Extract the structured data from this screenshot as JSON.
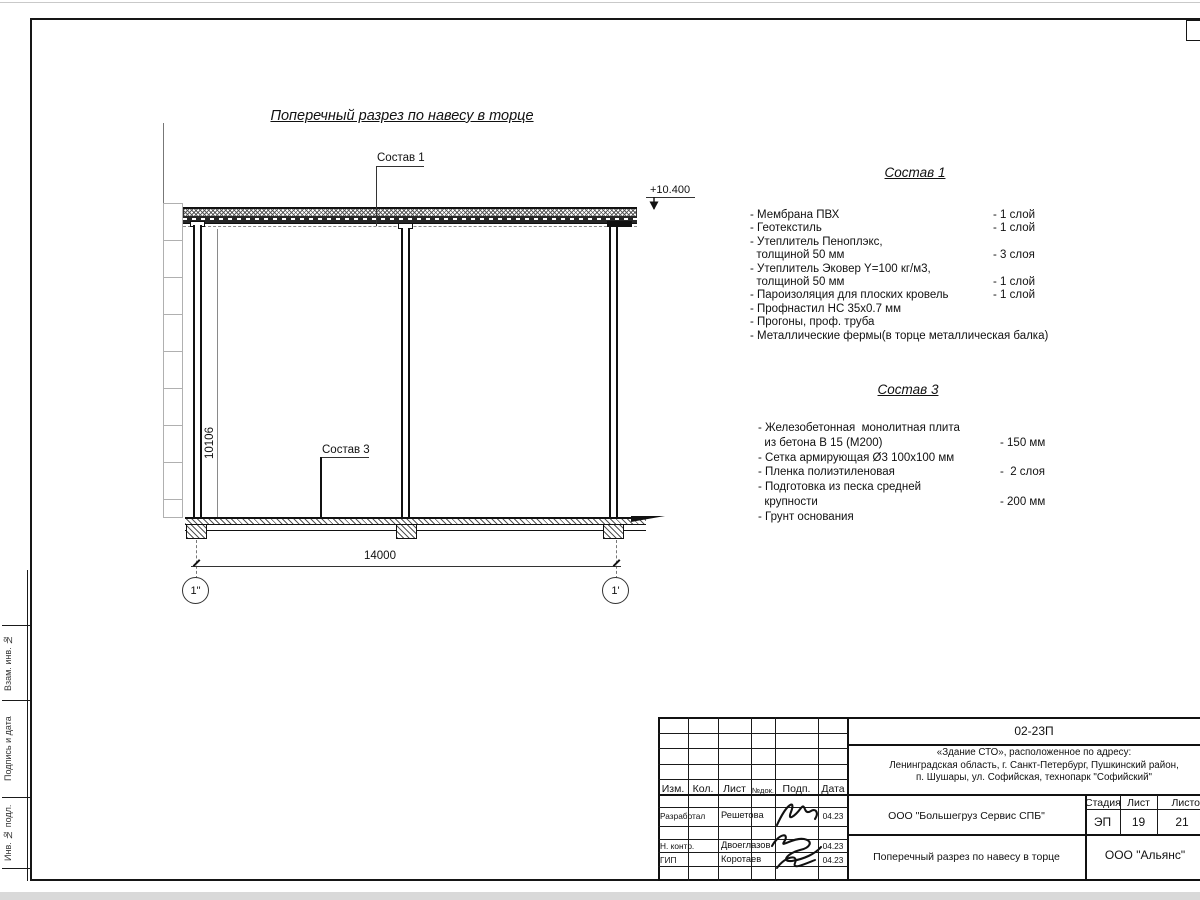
{
  "colors": {
    "line": "#1a1a1a",
    "aux_line": "#b0b0b0"
  },
  "drawing": {
    "title": "Поперечный разрез по навесу в торце",
    "leader1_label": "Состав 1",
    "leader3_label": "Состав 3",
    "elevation_mark": "+10.400",
    "dim_horizontal": "14000",
    "dim_vertical": "10106",
    "axis_left": "1\"",
    "axis_right": "1'"
  },
  "composition1": {
    "heading": "Состав 1",
    "rows": [
      {
        "t": "- Мембрана ПВХ",
        "v": "- 1 слой"
      },
      {
        "t": "- Геотекстиль",
        "v": "- 1 слой"
      },
      {
        "t": "- Утеплитель Пеноплэкс,",
        "v": ""
      },
      {
        "t": "  толщиной 50 мм",
        "v": "- 3 слоя"
      },
      {
        "t": "- Утеплитель Эковер Y=100 кг/м3,",
        "v": ""
      },
      {
        "t": "  толщиной 50 мм",
        "v": "- 1 слой"
      },
      {
        "t": "- Пароизоляция для плоских кровель",
        "v": "- 1 слой"
      },
      {
        "t": "- Профнастил НС 35х0.7 мм",
        "v": ""
      },
      {
        "t": "- Прогоны, проф. труба",
        "v": ""
      },
      {
        "t": "- Металлические фермы(в торце металлическая балка)",
        "v": ""
      }
    ]
  },
  "composition3": {
    "heading": "Состав 3",
    "rows": [
      {
        "t": "- Железобетонная  монолитная плита",
        "v": ""
      },
      {
        "t": "  из бетона В 15 (М200)",
        "v": "- 150 мм"
      },
      {
        "t": "- Сетка армирующая Ø3 100х100 мм",
        "v": ""
      },
      {
        "t": "- Пленка полиэтиленовая",
        "v": "-  2 слоя"
      },
      {
        "t": "- Подготовка из песка средней",
        "v": ""
      },
      {
        "t": "  крупности",
        "v": "- 200 мм"
      },
      {
        "t": "- Грунт основания",
        "v": ""
      }
    ]
  },
  "titleblock": {
    "code": "02-23П",
    "address1": "«Здание СТО», расположенное по адресу:",
    "address2": "Ленинградская область, г. Санкт-Петербург, Пушкинский район,",
    "address3": "п. Шушары, ул. Софийская, технопарк \"Софийский\"",
    "col_izm": "Изм.",
    "col_kol": "Кол.",
    "col_list": "Лист",
    "col_ndok": "№док.",
    "col_podp": "Подп.",
    "col_data": "Дата",
    "row1_role": "Разработал",
    "row1_name": "Решетова",
    "row1_date": "04.23",
    "row2_role": "Н. контр.",
    "row2_name": "Двоеглазов",
    "row2_date": "04.23",
    "row3_role": "ГИП",
    "row3_name": "Коротаев",
    "row3_date": "04.23",
    "company": "ООО \"Большегруз Сервис СПБ\"",
    "stage_label": "Стадия",
    "sheet_label": "Лист",
    "sheets_label": "Листов",
    "stage": "ЭП",
    "sheet": "19",
    "sheets": "21",
    "doc_title": "Поперечный разрез по навесу в торце",
    "org": "ООО \"Альянс\""
  },
  "side_labels": {
    "a": "Взам. инв. №",
    "b": "Подпись и дата",
    "c": "Инв. № подл."
  }
}
